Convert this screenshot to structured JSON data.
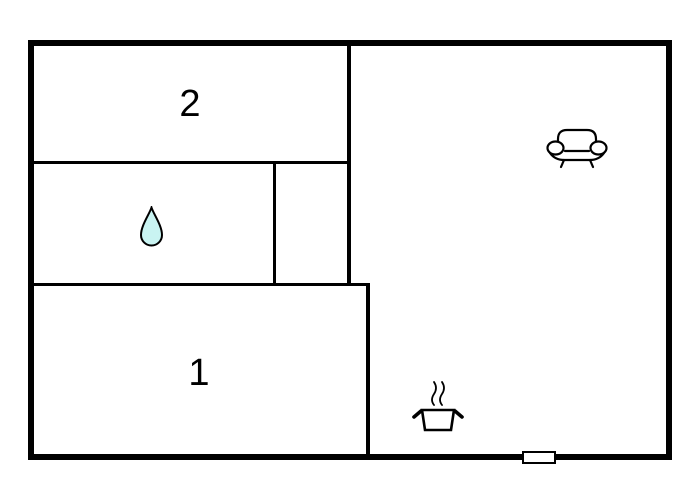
{
  "floorplan": {
    "background_color": "#ffffff",
    "wall_color": "#000000",
    "rooms": [
      {
        "label": "2"
      },
      {
        "label": "1"
      }
    ],
    "symbols": {
      "water_drop": {
        "icon": "water-drop-icon",
        "fill": "#c9f4f2",
        "outline": "#000000"
      },
      "sofa": {
        "icon": "sofa-icon",
        "outline": "#000000"
      },
      "cooking_pot": {
        "icon": "cooking-pot-icon",
        "outline": "#000000"
      },
      "window": {
        "icon": "window-marker",
        "fill": "#ffffff",
        "outline": "#000000"
      }
    }
  }
}
